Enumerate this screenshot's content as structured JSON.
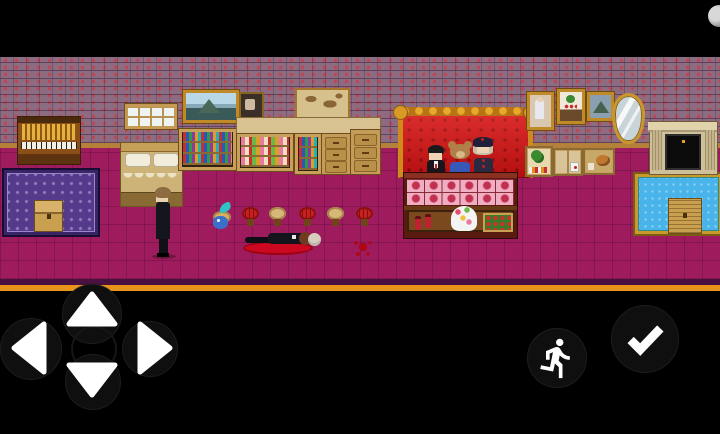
{
  "window": {
    "width": 720,
    "height": 434,
    "letterbox_color": "#000000",
    "type": "mobile-rpg-game-screen"
  },
  "game_scene": {
    "name": "mansion-parlor-murder-scene",
    "style": "pixel-art top-down RPG",
    "colors": {
      "wall_brick": "#8d6b80",
      "wall_mortar": "#3a223a",
      "wall_accent_red": "#cd3a46",
      "floor_magenta": "#9e1c5e",
      "skirting_tan": "#b5813a",
      "bottom_band_purple": "#4a1040",
      "bottom_band_orange": "#e8941c",
      "blood_red": "#cc0820",
      "sofa_red": "#c81414",
      "sofa_gold": "#d08a1c",
      "rug_purple": "#553a8c",
      "rug_blue": "#49b4ea",
      "wood_tan": "#c8a05c"
    },
    "objects": [
      {
        "name": "pipe-organ"
      },
      {
        "name": "purple-ornate-rug"
      },
      {
        "name": "small-wooden-chest-on-purple-rug"
      },
      {
        "name": "wall-window"
      },
      {
        "name": "double-bed"
      },
      {
        "name": "mountain-landscape-painting"
      },
      {
        "name": "bookshelf-left"
      },
      {
        "name": "small-framed-portrait"
      },
      {
        "name": "parchment-wall-map"
      },
      {
        "name": "counter-top-run"
      },
      {
        "name": "curio-toy-shelf"
      },
      {
        "name": "bookshelf-narrow"
      },
      {
        "name": "drawer-cabinet-1"
      },
      {
        "name": "drawer-cabinet-2"
      },
      {
        "name": "red-tufted-sofa-gold-trim"
      },
      {
        "name": "ornate-pink-panel-counter"
      },
      {
        "name": "potion-bottles"
      },
      {
        "name": "dessert-cake-stand"
      },
      {
        "name": "flower-crate"
      },
      {
        "name": "portrait-painting"
      },
      {
        "name": "still-life-painting"
      },
      {
        "name": "small-landscape-painting"
      },
      {
        "name": "gold-oval-mirror"
      },
      {
        "name": "display-box-plant"
      },
      {
        "name": "display-box-paper"
      },
      {
        "name": "display-box-cat"
      },
      {
        "name": "stone-fireplace"
      },
      {
        "name": "blue-gold-rug"
      },
      {
        "name": "slatted-wooden-chest-on-blue-rug"
      },
      {
        "name": "red-cushion-stool",
        "count": 3
      },
      {
        "name": "wooden-stool",
        "count": 2
      },
      {
        "name": "blood-splatter"
      }
    ],
    "characters": [
      {
        "name": "butler",
        "desc": "tall man in black suit standing, brown hair, facing left"
      },
      {
        "name": "blue-bird",
        "desc": "small blue bird with teal crest perched on stool"
      },
      {
        "name": "suited-man-seated",
        "desc": "black suit, white shirt, red tie, on sofa behind counter"
      },
      {
        "name": "teddy-bear-seated",
        "desc": "brown bear in blue outfit, on sofa behind counter"
      },
      {
        "name": "hatted-girl-seated",
        "desc": "dark hat with red dot, pale hair, dark coat with red buttons"
      },
      {
        "name": "dead-body",
        "desc": "man in black suit lying in pool of blood, head to the right"
      }
    ]
  },
  "hud": {
    "style": "black touch-control bars top and bottom",
    "dpad": {
      "buttons": [
        {
          "id": "up",
          "icon": "arrow-up-icon"
        },
        {
          "id": "down",
          "icon": "arrow-down-icon"
        },
        {
          "id": "left",
          "icon": "arrow-left-icon"
        },
        {
          "id": "right",
          "icon": "arrow-right-icon"
        }
      ],
      "arrow_color": "#ffffff",
      "circle_color": "#0f0f0f"
    },
    "run_button": {
      "icon": "running-person-icon",
      "icon_color": "#ffffff",
      "bg": "#0f0f0f"
    },
    "confirm_button": {
      "icon": "checkmark-icon",
      "icon_color": "#ffffff",
      "bg": "#0f0f0f"
    },
    "top_right_indicator": {
      "icon": "partial-moon-circle",
      "color": "#d8d8d8"
    }
  }
}
